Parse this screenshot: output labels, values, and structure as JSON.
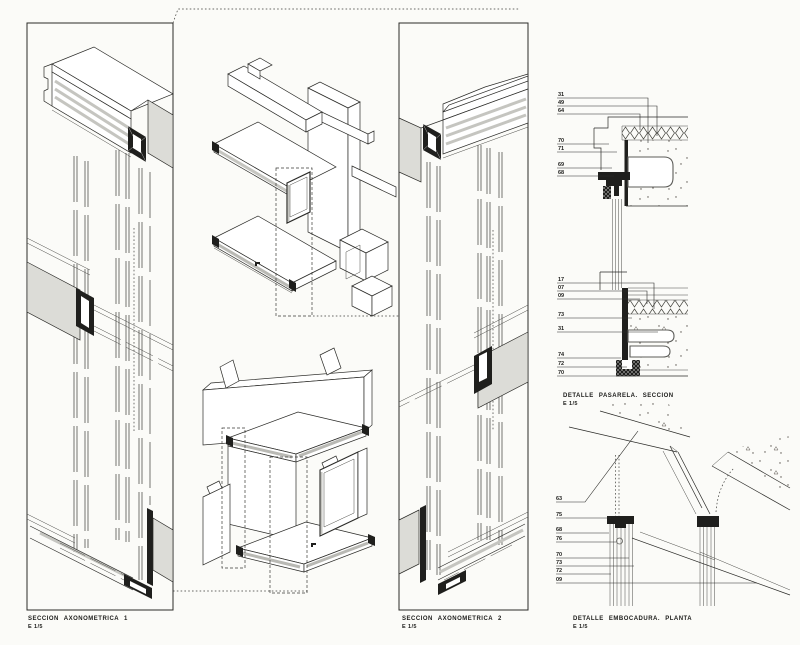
{
  "sheet": {
    "background": "#fbfbf8",
    "line_color": "#2b2b28",
    "accent_grey": "#dcdcd7",
    "profile_dark": "#1f1f1d"
  },
  "panels": {
    "axo1": {
      "title": "SECCION AXONOMETRICA 1",
      "scale": "E 1/5"
    },
    "axo2": {
      "title": "SECCION AXONOMETRICA 2",
      "scale": "E 1/5"
    },
    "pasarela": {
      "title": "DETALLE PASARELA. SECCION",
      "scale": "E 1/5"
    },
    "embocadura": {
      "title": "DETALLE EMBOCADURA. PLANTA",
      "scale": "E 1/5"
    }
  },
  "callouts": {
    "pasarela_top": [
      "31",
      "49",
      "64",
      "70",
      "71",
      "69",
      "68"
    ],
    "pasarela_bottom": [
      "17",
      "07",
      "09",
      "73",
      "31",
      "74",
      "72",
      "70"
    ],
    "embocadura": [
      "63",
      "75",
      "68",
      "76",
      "70",
      "73",
      "72",
      "09"
    ]
  }
}
